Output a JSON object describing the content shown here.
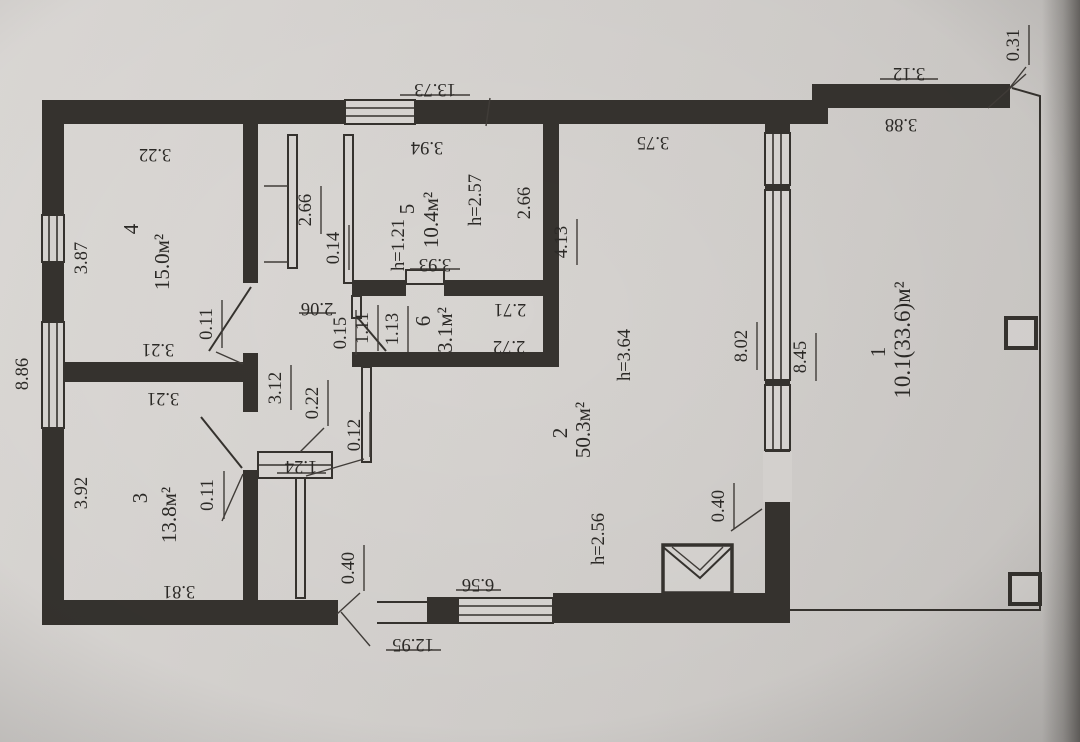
{
  "document": {
    "kind": "floor-plan-photo",
    "paper_color": "#d6d3d0",
    "ink_color": "#36332f"
  },
  "rooms": {
    "r1": {
      "number": "1",
      "area": "10.1(33.6)м²"
    },
    "r2": {
      "number": "2",
      "area": "50.3м²",
      "height": "h=3.64",
      "height_low": "h=2.56"
    },
    "r3": {
      "number": "3",
      "area": "13.8м²"
    },
    "r4": {
      "number": "4",
      "area": "15.0м²"
    },
    "r5": {
      "number": "5",
      "area": "10.4м²",
      "height": "h=2.57",
      "niche_height": "h=1.21"
    },
    "r6": {
      "number": "6",
      "area": "3.1м²"
    }
  },
  "dims": {
    "top_total": "13.73",
    "top_right": "3.12",
    "corner_return": "0.31",
    "room4_top": "3.22",
    "room5_top": "3.94",
    "room2_top": "3.75",
    "room1_top": "3.88",
    "room4_left": "3.87",
    "left_total": "8.86",
    "room3_left": "3.92",
    "room4_bottom": "3.21",
    "room3_top": "3.21",
    "room3_bottom": "3.81",
    "room4_door_return": "0.11",
    "room3_door_return": "0.11",
    "closet_height": "2.66",
    "closet_partition": "0.14",
    "hall_width": "2.06",
    "hall_length": "3.12",
    "hall_wall": "0.22",
    "thin_partition": "0.12",
    "closet_width": "1.24",
    "niche_width": "3.93",
    "room6_partition": "0.15",
    "room6_dim1": "1.11",
    "room6_dim2": "1.13",
    "room6_top": "2.71",
    "room6_bottom": "2.72",
    "room5_right": "2.66",
    "room2_left_upper": "4.13",
    "wall_end_left": "0.40",
    "wall_end_right": "0.40",
    "bottom_window": "6.56",
    "bottom_total": "12.95",
    "room2_right": "8.02",
    "room1_left": "8.45"
  }
}
